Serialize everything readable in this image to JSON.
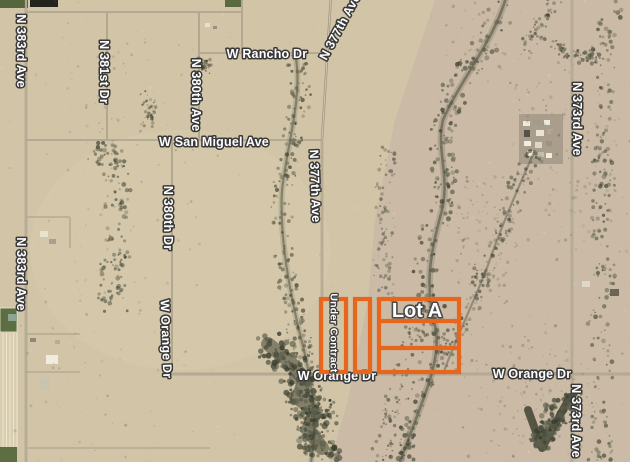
{
  "map": {
    "type": "satellite-imagery",
    "road_labels": [
      {
        "id": "n-383rd-ave-top",
        "text": "N 383rd Ave"
      },
      {
        "id": "n-383rd-ave-bottom",
        "text": "N 383rd Ave"
      },
      {
        "id": "n-381st-dr",
        "text": "N 381st Dr"
      },
      {
        "id": "n-380th-ave",
        "text": "N 380th Ave"
      },
      {
        "id": "n-380th-dr",
        "text": "N 380th Dr"
      },
      {
        "id": "n-377th-ave-top",
        "text": "N 377th Ave"
      },
      {
        "id": "n-377th-ave-mid",
        "text": "N 377th Ave"
      },
      {
        "id": "n-373rd-ave-top",
        "text": "N 373rd Ave"
      },
      {
        "id": "n-373rd-ave-bottom",
        "text": "N 373rd Ave"
      },
      {
        "id": "w-rancho-dr",
        "text": "W Rancho Dr"
      },
      {
        "id": "w-san-miguel-ave",
        "text": "W San Miguel Ave"
      },
      {
        "id": "w-orange-dr-west",
        "text": "W Orange Dr"
      },
      {
        "id": "w-orange-dr-center",
        "text": "W Orange Dr"
      },
      {
        "id": "w-orange-dr-east",
        "text": "W Orange Dr"
      }
    ]
  },
  "parcel_overlay": {
    "lot_a_label": "Lot A",
    "under_contract_label": "Under Contract",
    "outline_color": "#E8661C"
  },
  "colors": {
    "desert_base": "#D2C4A7",
    "label_text": "#FFFFFF",
    "label_outline": "#383838"
  }
}
